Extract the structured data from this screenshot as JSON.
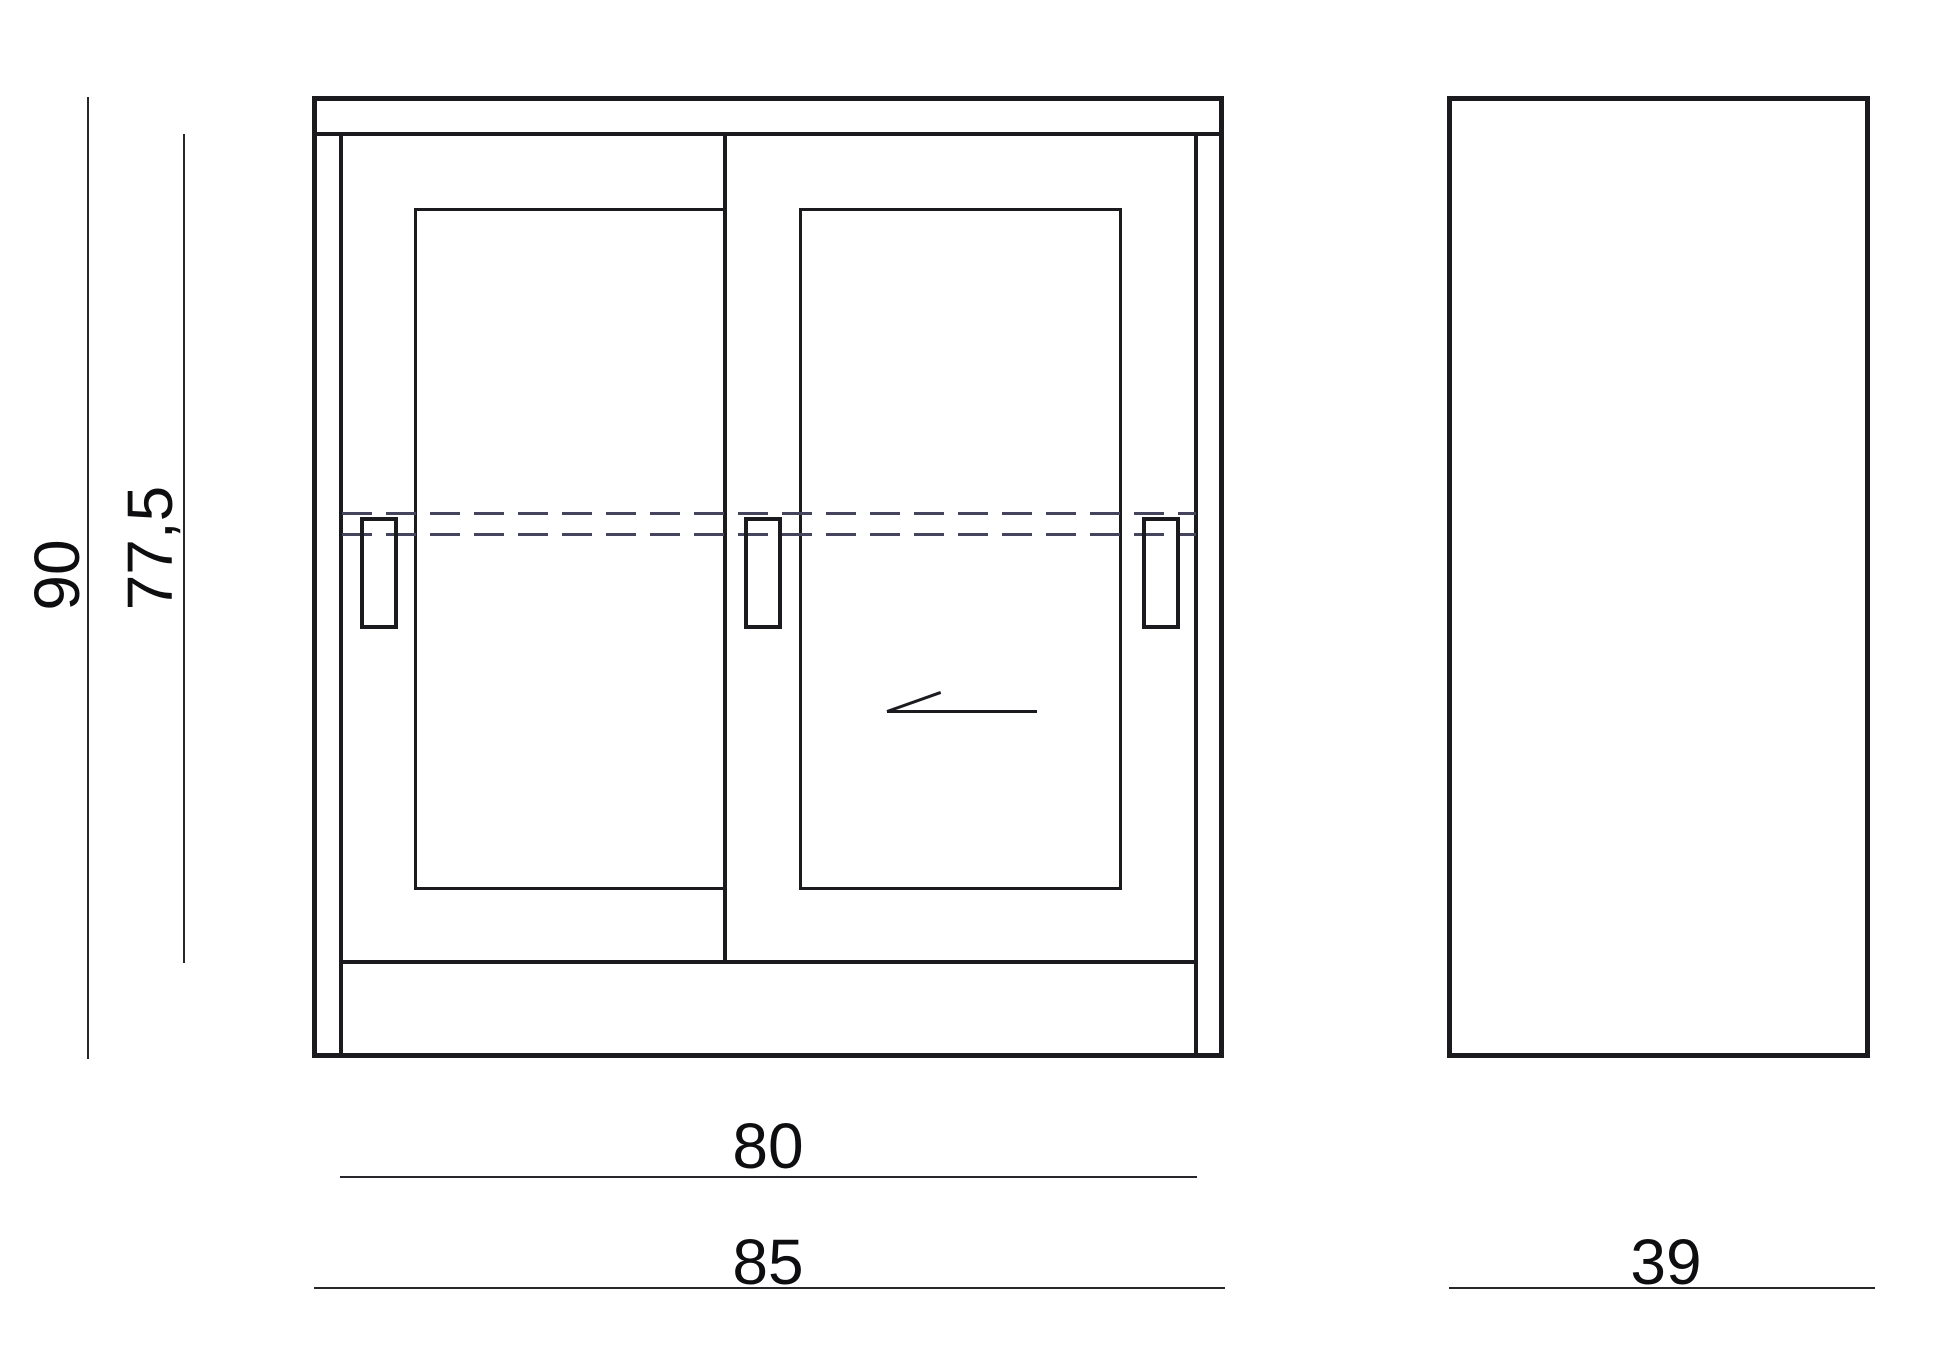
{
  "drawing": {
    "type": "furniture dimension drawing",
    "views": {
      "front": "cabinet with two sliding doors",
      "side": "side profile rectangle"
    },
    "dimensions": {
      "total_height": "90",
      "door_height": "77,5",
      "opening_width": "80",
      "total_width": "85",
      "depth": "39"
    },
    "colors": {
      "line": "#1b1b1f",
      "thin_line": "#26262b",
      "hidden_line": "#44445c",
      "text": "#0e0e11",
      "background": "#ffffff"
    }
  }
}
